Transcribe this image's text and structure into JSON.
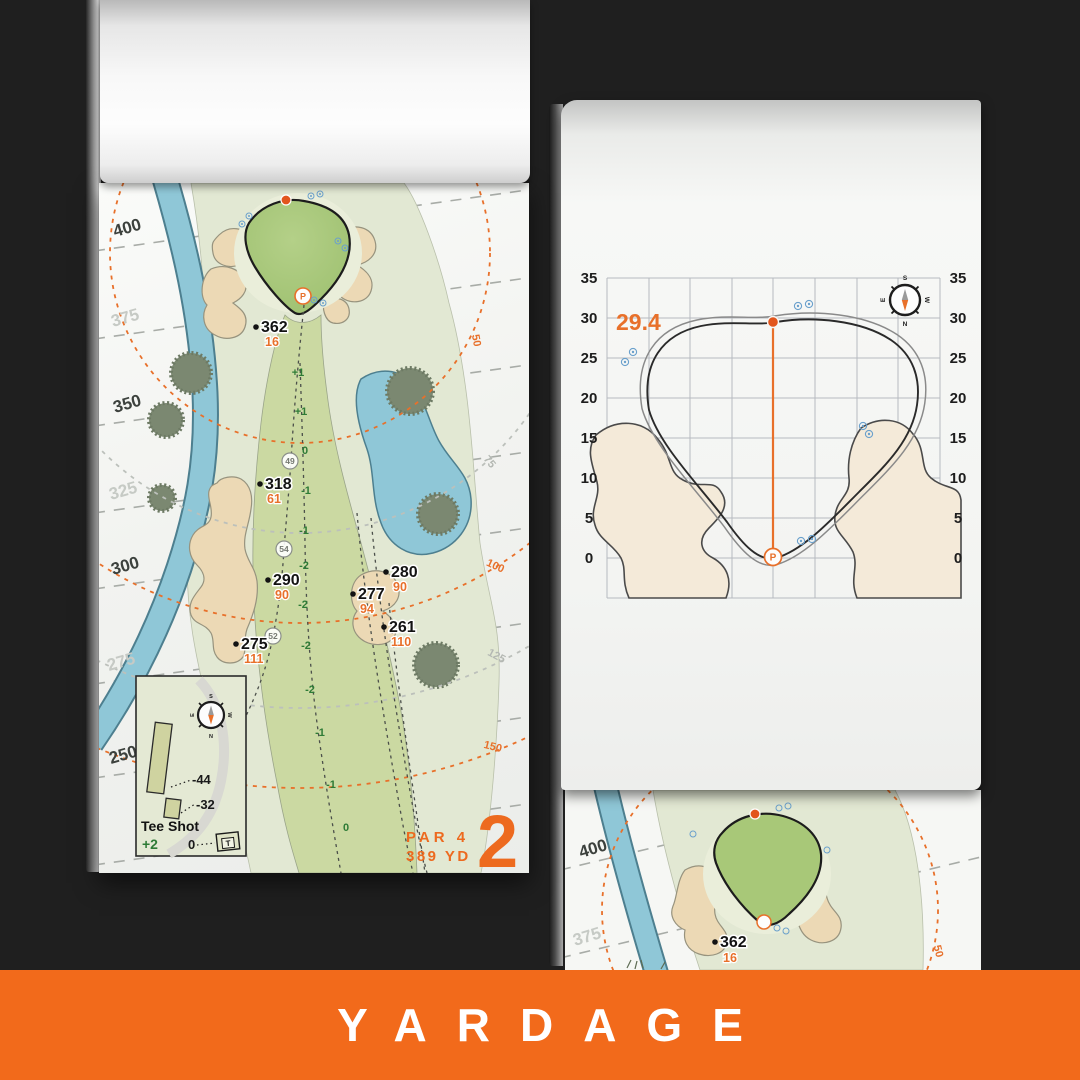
{
  "banner": {
    "title": "YARDAGE"
  },
  "colors": {
    "background_dark": "#1F1F1F",
    "banner_orange": "#F26A1B",
    "map_orange": "#E8702A",
    "elevation_green": "#2E7B36",
    "water_blue": "#8FC7D7",
    "green_fill": "#A8C878",
    "bunker_sand": "#ECD9B5",
    "page_white": "#F6F7F5"
  },
  "shared": {
    "pin_label": "P",
    "compass": {
      "n": "N",
      "s": "S",
      "e": "E",
      "w": "W"
    }
  },
  "left_page": {
    "hole_number": "2",
    "par_label": "PAR 4",
    "yardage_label": "389 YD",
    "distance_ticks": [
      "400",
      "375",
      "350",
      "325",
      "300",
      "275",
      "250"
    ],
    "arc_labels": [
      "50",
      "75",
      "100",
      "125",
      "150"
    ],
    "markers": [
      {
        "carry": "362",
        "to_front": "16"
      },
      {
        "carry": "318",
        "to_front": "61"
      },
      {
        "carry": "290",
        "to_front": "90"
      },
      {
        "carry": "280",
        "to_front": "90"
      },
      {
        "carry": "277",
        "to_front": "94"
      },
      {
        "carry": "261",
        "to_front": "110"
      },
      {
        "carry": "275",
        "to_front": "111"
      }
    ],
    "mid_markers": [
      "49",
      "54",
      "52"
    ],
    "elevations": [
      "+1",
      "+1",
      "0",
      "-1",
      "-1",
      "-2",
      "-2",
      "-2",
      "-2",
      "-1",
      "-1",
      "0"
    ],
    "inset": {
      "title": "Tee Shot",
      "score": "+2",
      "back_width": "-44",
      "front_width": "-32",
      "zero": "0",
      "tee_marker": "T"
    }
  },
  "right_page": {
    "depth_label": "29.4",
    "axis_ticks": [
      "35",
      "30",
      "25",
      "20",
      "15",
      "10",
      "5",
      "0"
    ]
  },
  "under_page": {
    "distance_ticks": [
      "400",
      "375"
    ],
    "marker": {
      "carry": "362",
      "to_front": "16"
    },
    "arc_label": "50"
  }
}
